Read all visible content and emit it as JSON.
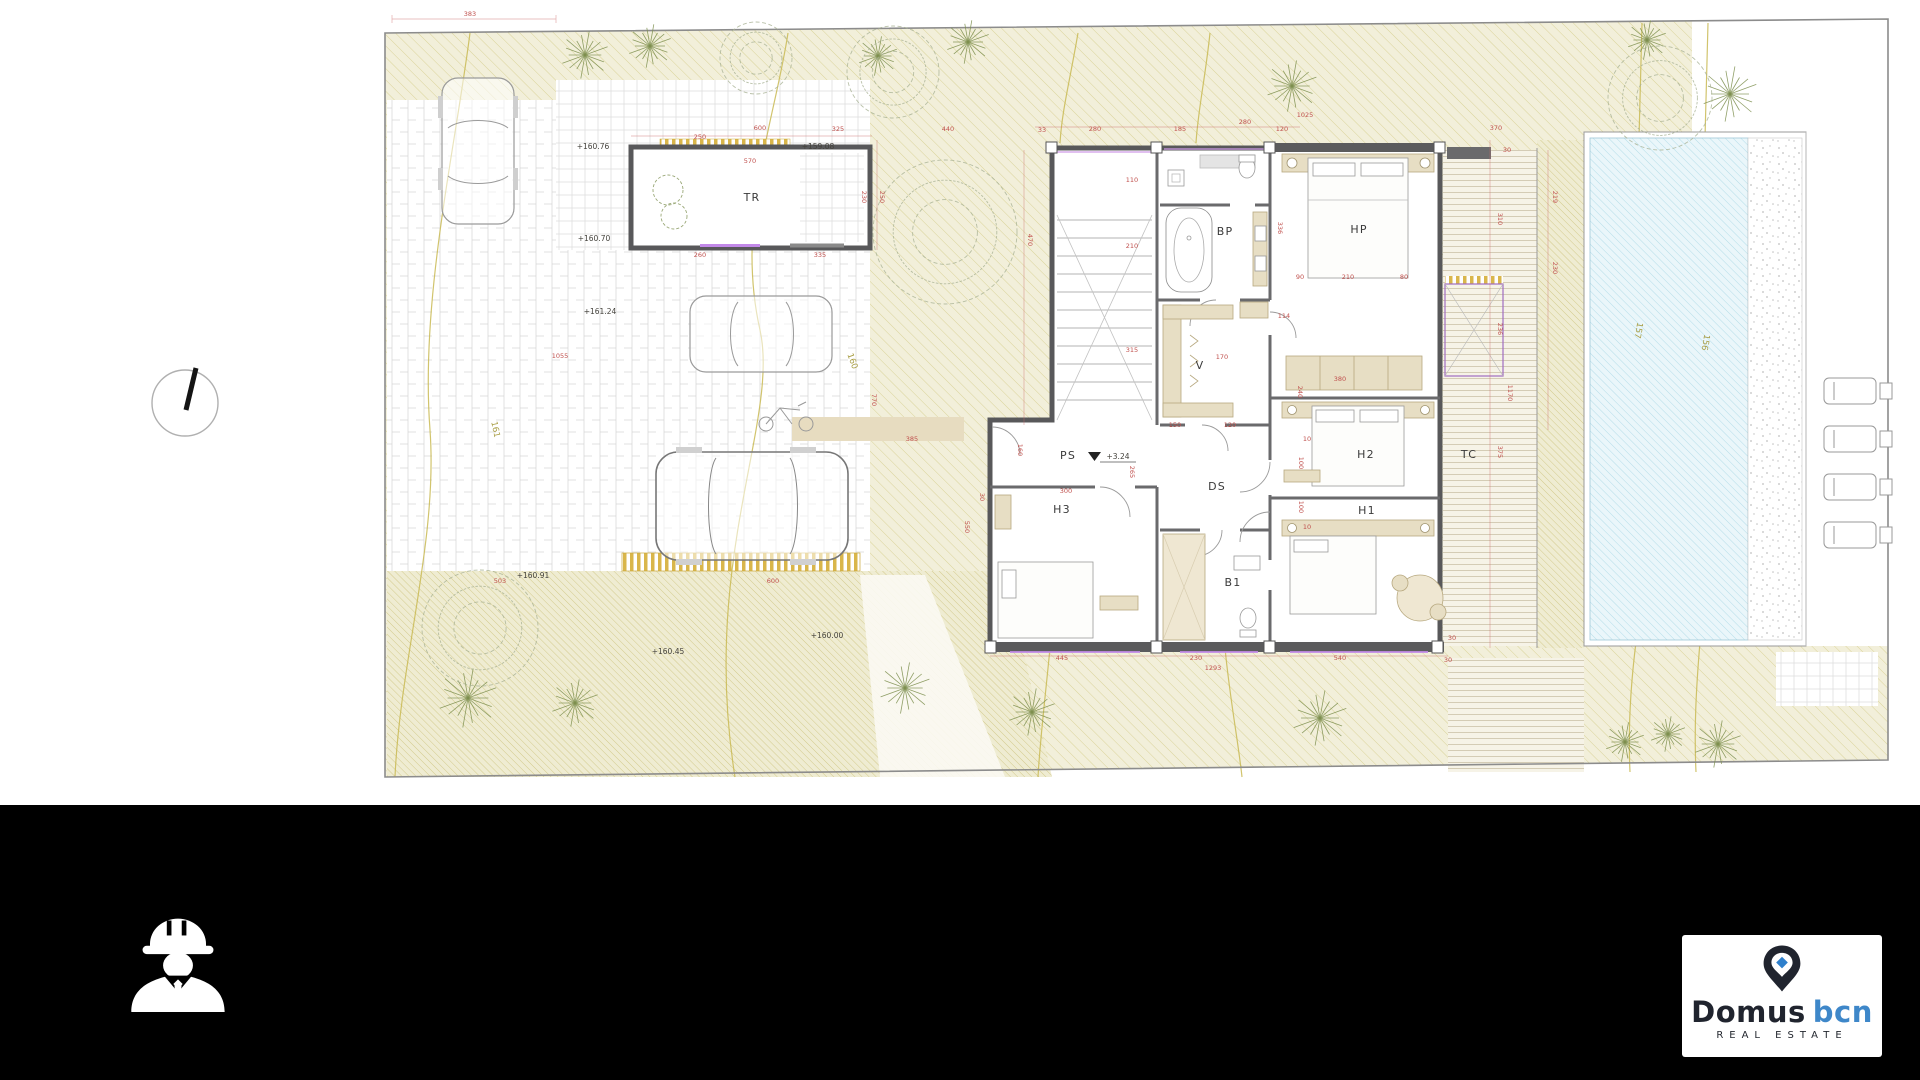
{
  "page": {
    "background": "#ffffff",
    "footer_background": "#000000"
  },
  "footer": {
    "brand": {
      "primary": "Domus",
      "secondary": "bcn",
      "tagline": "REAL ESTATE",
      "navy": "#20242e",
      "blue": "#3e87c9"
    },
    "icons": [
      "engineer-icon",
      "map-pin-icon"
    ]
  },
  "plan": {
    "colors": {
      "wall": "#58585a",
      "dimension": "#c0504d",
      "contour": "#c9ba54",
      "pool_water": "#eaf6fa",
      "garden": "#f2efda",
      "accent_magenta": "#c289e8"
    },
    "rooms": [
      {
        "t": "TR",
        "x": 752,
        "y": 201
      },
      {
        "t": "BP",
        "x": 1225,
        "y": 235
      },
      {
        "t": "HP",
        "x": 1359,
        "y": 233
      },
      {
        "t": "V",
        "x": 1200,
        "y": 369
      },
      {
        "t": "DS",
        "x": 1217,
        "y": 490
      },
      {
        "t": "H2",
        "x": 1366,
        "y": 458
      },
      {
        "t": "TC",
        "x": 1469,
        "y": 458
      },
      {
        "t": "H1",
        "x": 1367,
        "y": 514
      },
      {
        "t": "H3",
        "x": 1062,
        "y": 513
      },
      {
        "t": "B1",
        "x": 1233,
        "y": 586
      },
      {
        "t": "PS",
        "x": 1068,
        "y": 459
      }
    ],
    "levels": [
      {
        "t": "+160.76",
        "x": 593,
        "y": 149
      },
      {
        "t": "+159.08",
        "x": 818,
        "y": 149
      },
      {
        "t": "+160.70",
        "x": 594,
        "y": 241
      },
      {
        "t": "+161.24",
        "x": 600,
        "y": 314
      },
      {
        "t": "+160.91",
        "x": 533,
        "y": 578
      },
      {
        "t": "+160.45",
        "x": 668,
        "y": 654
      },
      {
        "t": "+160.00",
        "x": 827,
        "y": 638
      },
      {
        "t": "+3.24",
        "x": 1118,
        "y": 459
      }
    ],
    "contour_labels": [
      {
        "t": "157",
        "x": 1636,
        "y": 330,
        "r": 100
      },
      {
        "t": "156",
        "x": 1703,
        "y": 342,
        "r": 100
      },
      {
        "t": "161",
        "x": 493,
        "y": 430,
        "r": 78
      },
      {
        "t": "160",
        "x": 850,
        "y": 362,
        "r": 70
      }
    ],
    "dimensions": [
      {
        "t": "383",
        "x": 470,
        "y": 16
      },
      {
        "t": "1055",
        "x": 560,
        "y": 358
      },
      {
        "t": "600",
        "x": 760,
        "y": 130
      },
      {
        "t": "325",
        "x": 838,
        "y": 131
      },
      {
        "t": "250",
        "x": 700,
        "y": 139
      },
      {
        "t": "570",
        "x": 750,
        "y": 163
      },
      {
        "t": "230",
        "x": 862,
        "y": 197,
        "r": 90
      },
      {
        "t": "250",
        "x": 880,
        "y": 197,
        "r": 90
      },
      {
        "t": "260",
        "x": 700,
        "y": 257
      },
      {
        "t": "335",
        "x": 820,
        "y": 257
      },
      {
        "t": "440",
        "x": 948,
        "y": 131
      },
      {
        "t": "33",
        "x": 1042,
        "y": 132
      },
      {
        "t": "280",
        "x": 1095,
        "y": 131
      },
      {
        "t": "185",
        "x": 1180,
        "y": 131
      },
      {
        "t": "280",
        "x": 1245,
        "y": 124
      },
      {
        "t": "120",
        "x": 1282,
        "y": 131
      },
      {
        "t": "1025",
        "x": 1305,
        "y": 117
      },
      {
        "t": "110",
        "x": 1132,
        "y": 182
      },
      {
        "t": "210",
        "x": 1132,
        "y": 248
      },
      {
        "t": "315",
        "x": 1132,
        "y": 352
      },
      {
        "t": "470",
        "x": 1028,
        "y": 240,
        "r": 90
      },
      {
        "t": "170",
        "x": 1222,
        "y": 359
      },
      {
        "t": "336",
        "x": 1278,
        "y": 228,
        "r": 90
      },
      {
        "t": "90",
        "x": 1300,
        "y": 279
      },
      {
        "t": "210",
        "x": 1348,
        "y": 279
      },
      {
        "t": "80",
        "x": 1404,
        "y": 279
      },
      {
        "t": "114",
        "x": 1284,
        "y": 318
      },
      {
        "t": "380",
        "x": 1340,
        "y": 381
      },
      {
        "t": "240",
        "x": 1298,
        "y": 392,
        "r": 90
      },
      {
        "t": "150",
        "x": 1175,
        "y": 427
      },
      {
        "t": "120",
        "x": 1230,
        "y": 427
      },
      {
        "t": "10",
        "x": 1307,
        "y": 441
      },
      {
        "t": "100",
        "x": 1299,
        "y": 463,
        "r": 90
      },
      {
        "t": "100",
        "x": 1299,
        "y": 507,
        "r": 90
      },
      {
        "t": "10",
        "x": 1307,
        "y": 529
      },
      {
        "t": "265",
        "x": 1130,
        "y": 472,
        "r": 90
      },
      {
        "t": "300",
        "x": 1066,
        "y": 493
      },
      {
        "t": "160",
        "x": 1018,
        "y": 450,
        "r": 90
      },
      {
        "t": "770",
        "x": 872,
        "y": 400,
        "r": 90
      },
      {
        "t": "385",
        "x": 912,
        "y": 441
      },
      {
        "t": "550",
        "x": 965,
        "y": 527,
        "r": 90
      },
      {
        "t": "30",
        "x": 980,
        "y": 497,
        "r": 90
      },
      {
        "t": "370",
        "x": 1496,
        "y": 130
      },
      {
        "t": "30",
        "x": 1507,
        "y": 152
      },
      {
        "t": "310",
        "x": 1498,
        "y": 219,
        "r": 90
      },
      {
        "t": "236",
        "x": 1498,
        "y": 329,
        "r": 90
      },
      {
        "t": "1170",
        "x": 1508,
        "y": 393,
        "r": 90
      },
      {
        "t": "375",
        "x": 1498,
        "y": 452,
        "r": 90
      },
      {
        "t": "219",
        "x": 1553,
        "y": 197,
        "r": 90
      },
      {
        "t": "230",
        "x": 1553,
        "y": 268,
        "r": 90
      },
      {
        "t": "445",
        "x": 1062,
        "y": 660
      },
      {
        "t": "230",
        "x": 1196,
        "y": 660
      },
      {
        "t": "1293",
        "x": 1213,
        "y": 670
      },
      {
        "t": "540",
        "x": 1340,
        "y": 660
      },
      {
        "t": "30",
        "x": 1452,
        "y": 640
      },
      {
        "t": "30",
        "x": 1448,
        "y": 662
      },
      {
        "t": "503",
        "x": 500,
        "y": 583
      },
      {
        "t": "600",
        "x": 773,
        "y": 583
      }
    ],
    "trees": {
      "palms": [
        {
          "x": 585,
          "y": 55,
          "r": 24
        },
        {
          "x": 650,
          "y": 46,
          "r": 22
        },
        {
          "x": 878,
          "y": 56,
          "r": 20
        },
        {
          "x": 968,
          "y": 42,
          "r": 22
        },
        {
          "x": 1292,
          "y": 86,
          "r": 26
        },
        {
          "x": 1647,
          "y": 40,
          "r": 20
        },
        {
          "x": 1730,
          "y": 94,
          "r": 28
        },
        {
          "x": 575,
          "y": 703,
          "r": 24
        },
        {
          "x": 905,
          "y": 688,
          "r": 26
        },
        {
          "x": 1032,
          "y": 712,
          "r": 24
        },
        {
          "x": 1320,
          "y": 718,
          "r": 28
        },
        {
          "x": 1625,
          "y": 742,
          "r": 20
        },
        {
          "x": 1668,
          "y": 734,
          "r": 18
        },
        {
          "x": 1718,
          "y": 744,
          "r": 24
        },
        {
          "x": 468,
          "y": 698,
          "r": 30
        }
      ],
      "scribbles": [
        {
          "x": 945,
          "y": 232,
          "r": 72
        },
        {
          "x": 893,
          "y": 72,
          "r": 46
        },
        {
          "x": 480,
          "y": 628,
          "r": 58
        },
        {
          "x": 1660,
          "y": 98,
          "r": 52
        },
        {
          "x": 756,
          "y": 58,
          "r": 36
        }
      ]
    }
  }
}
